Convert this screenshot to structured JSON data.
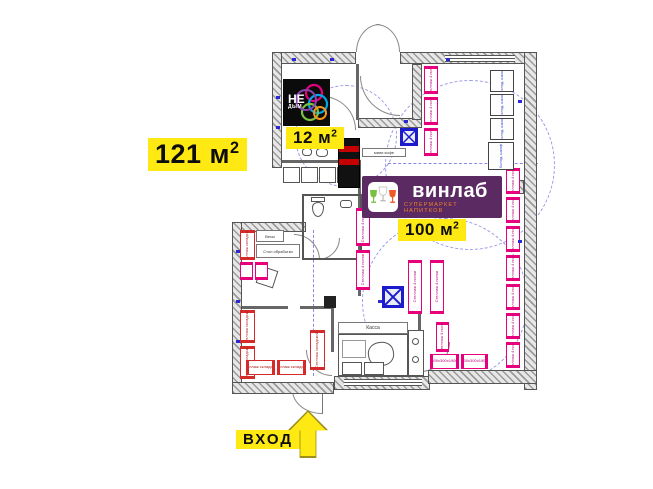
{
  "annotations": {
    "area_total": {
      "text": "121 м",
      "sup": "2"
    },
    "area_small": {
      "text": "12 м",
      "sup": "2"
    },
    "area_sales": {
      "text": "100 м",
      "sup": "2"
    },
    "entrance_label": "ВХОД"
  },
  "logos": {
    "nedym": {
      "top": "НЕ",
      "bottom": "ДЫМ"
    },
    "vinlab": {
      "name": "винлаб",
      "tagline": "СУПЕРМАРКЕТ НАПИТКОВ"
    }
  },
  "plan_items": {
    "shelf_label": "Стеллаж 4 полки",
    "shelf_dims": "600х300х1900",
    "storage_shelf_label": "Стеллаж складской",
    "fridge_label": "Холод. шкаф",
    "cashdesk_label": "Касса",
    "scales_label": "Весы",
    "prep_table_label": "Стол обработки",
    "coffee_label": "мини кофе"
  },
  "colors": {
    "highlight_yellow": "#ffe912",
    "shelf_pink": "#e6007e",
    "storage_red": "#d42a2a",
    "plan_blue": "#2a2ad0",
    "vinlab_purple": "#5b2a62",
    "vinlab_orange": "#f08327"
  }
}
